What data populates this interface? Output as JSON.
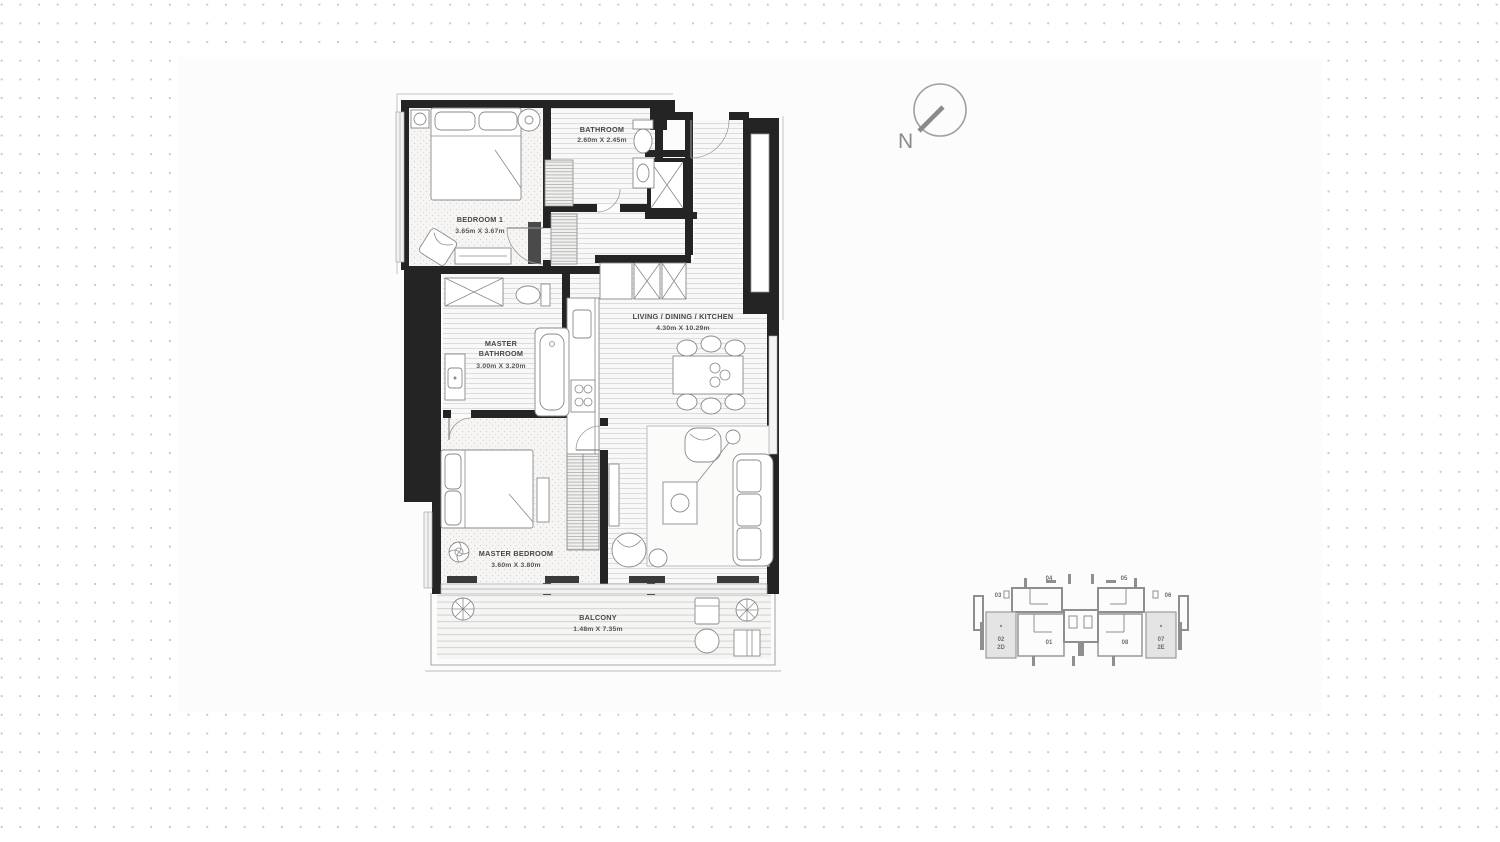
{
  "page": {
    "colors": {
      "dots": "#c9c9c9",
      "panel": "#fcfcfc",
      "wall": "#242424",
      "furniture_line": "#8a8a8a",
      "label_text": "#474747",
      "keyplan_line": "#8f8f8f",
      "keyplan_highlight": "#e4e4e4"
    }
  },
  "compass": {
    "label": "N"
  },
  "floorplan": {
    "rooms": {
      "bedroom1": {
        "name": "BEDROOM 1",
        "dims": "3.65m X 3.67m"
      },
      "bathroom": {
        "name": "BATHROOM",
        "dims": "2.60m X 2.45m"
      },
      "master_bathroom": {
        "name_line1": "MASTER",
        "name_line2": "BATHROOM",
        "dims": "3.00m X 3.20m"
      },
      "living": {
        "name": "LIVING / DINING / KITCHEN",
        "dims": "4.30m X 10.29m"
      },
      "master_bedroom": {
        "name": "MASTER BEDROOM",
        "dims": "3.60m X 3.80m"
      },
      "balcony": {
        "name": "BALCONY",
        "dims": "1.48m X 7.35m"
      }
    }
  },
  "keyplan": {
    "units": {
      "u01": "01",
      "u02": "02",
      "u02_type": "2D",
      "u03": "03",
      "u04": "04",
      "u05": "05",
      "u06": "06",
      "u07": "07",
      "u07_type": "2E",
      "u08": "08"
    }
  }
}
